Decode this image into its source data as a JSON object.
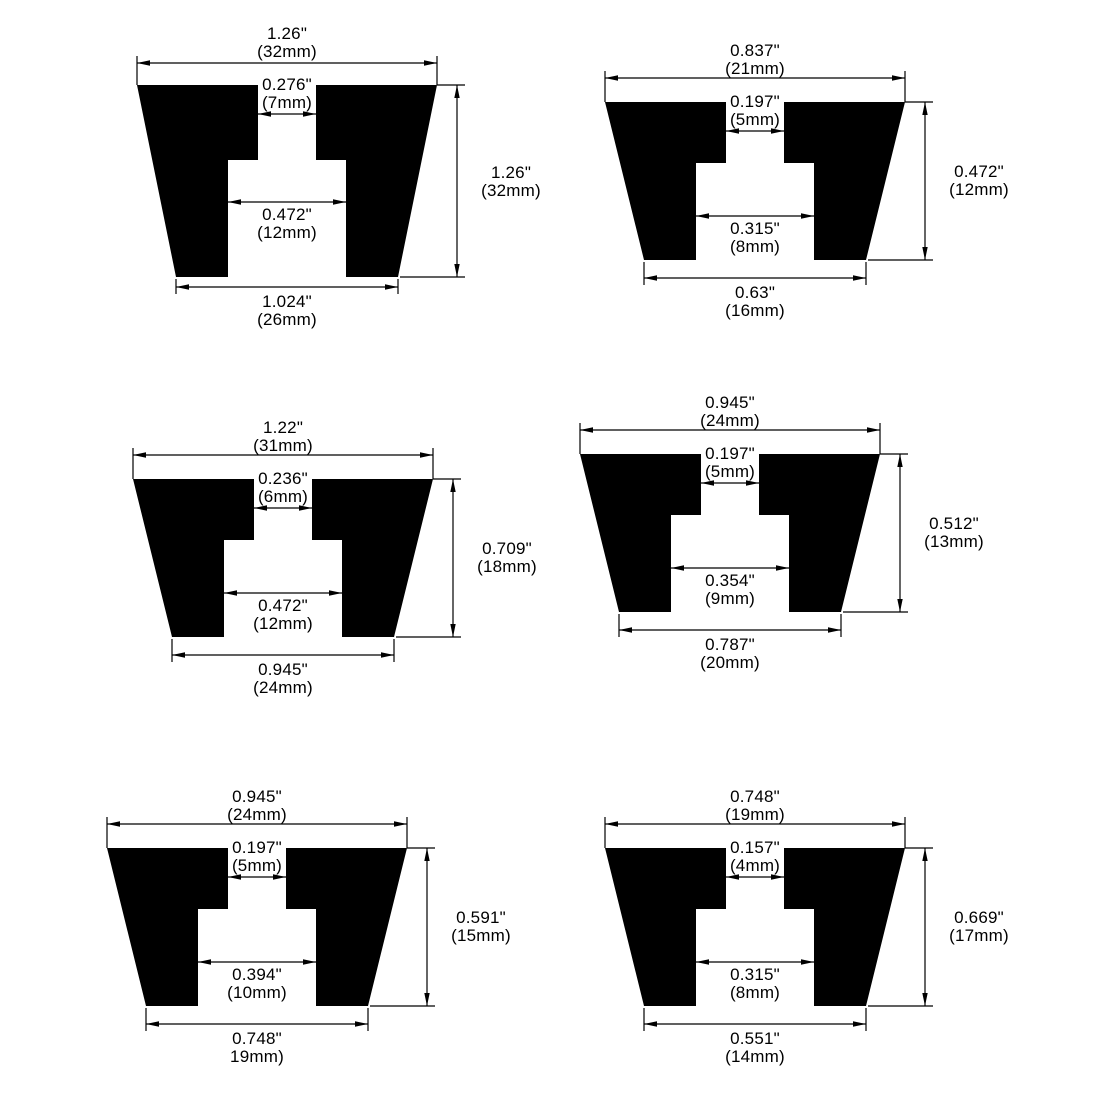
{
  "page": {
    "background": "#ffffff",
    "ink": "#000000",
    "description": "Six rubber-foot cross-section dimension diagrams in a 2x3 grid"
  },
  "diagrams": [
    {
      "position": "top-left",
      "top": {
        "in": "1.26\"",
        "mm": "(32mm)"
      },
      "notch": {
        "in": "0.276\"",
        "mm": "(7mm)"
      },
      "cavity": {
        "in": "0.472\"",
        "mm": "(12mm)"
      },
      "bottom": {
        "in": "1.024\"",
        "mm": "(26mm)"
      },
      "height": {
        "in": "1.26\"",
        "mm": "(32mm)"
      }
    },
    {
      "position": "top-right",
      "top": {
        "in": "0.837\"",
        "mm": "(21mm)"
      },
      "notch": {
        "in": "0.197\"",
        "mm": "(5mm)"
      },
      "cavity": {
        "in": "0.315\"",
        "mm": "(8mm)"
      },
      "bottom": {
        "in": "0.63\"",
        "mm": "(16mm)"
      },
      "height": {
        "in": "0.472\"",
        "mm": "(12mm)"
      }
    },
    {
      "position": "middle-left",
      "top": {
        "in": "1.22\"",
        "mm": "(31mm)"
      },
      "notch": {
        "in": "0.236\"",
        "mm": "(6mm)"
      },
      "cavity": {
        "in": "0.472\"",
        "mm": "(12mm)"
      },
      "bottom": {
        "in": "0.945\"",
        "mm": "(24mm)"
      },
      "height": {
        "in": "0.709\"",
        "mm": "(18mm)"
      }
    },
    {
      "position": "middle-right",
      "top": {
        "in": "0.945\"",
        "mm": "(24mm)"
      },
      "notch": {
        "in": "0.197\"",
        "mm": "(5mm)"
      },
      "cavity": {
        "in": "0.354\"",
        "mm": "(9mm)"
      },
      "bottom": {
        "in": "0.787\"",
        "mm": "(20mm)"
      },
      "height": {
        "in": "0.512\"",
        "mm": "(13mm)"
      }
    },
    {
      "position": "bottom-left",
      "top": {
        "in": "0.945\"",
        "mm": "(24mm)"
      },
      "notch": {
        "in": "0.197\"",
        "mm": "(5mm)"
      },
      "cavity": {
        "in": "0.394\"",
        "mm": "(10mm)"
      },
      "bottom": {
        "in": "0.748\"",
        "mm": "19mm)"
      },
      "height": {
        "in": "0.591\"",
        "mm": "(15mm)"
      }
    },
    {
      "position": "bottom-right",
      "top": {
        "in": "0.748\"",
        "mm": "(19mm)"
      },
      "notch": {
        "in": "0.157\"",
        "mm": "(4mm)"
      },
      "cavity": {
        "in": "0.315\"",
        "mm": "(8mm)"
      },
      "bottom": {
        "in": "0.551\"",
        "mm": "(14mm)"
      },
      "height": {
        "in": "0.669\"",
        "mm": "(17mm)"
      }
    }
  ]
}
